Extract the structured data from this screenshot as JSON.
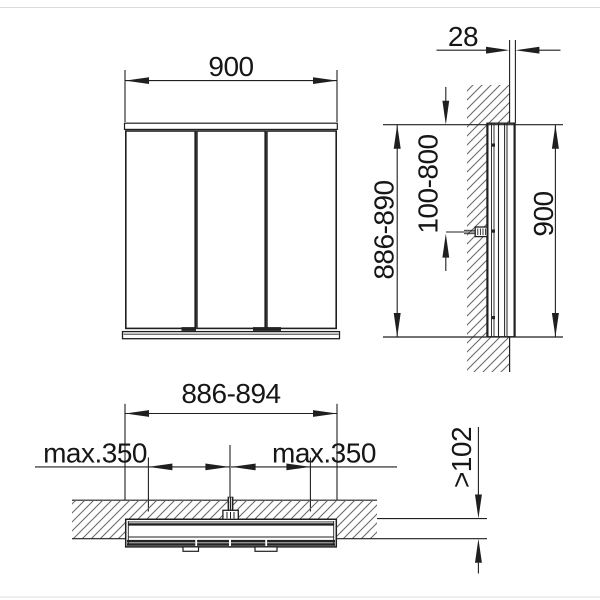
{
  "labels": {
    "front": {
      "width": "900"
    },
    "side": {
      "depth": "28",
      "recess_height": "886-890",
      "cable_outlet_range": "100-800",
      "height": "900"
    },
    "plan": {
      "width": "886-894",
      "door_swing_left": "max.350",
      "door_swing_right": "max.350",
      "recess_depth": ">102"
    }
  },
  "colors": {
    "line": "#1f1f1f",
    "hatch": "#6b6b6b",
    "background": "#ffffff",
    "text": "#161616"
  }
}
